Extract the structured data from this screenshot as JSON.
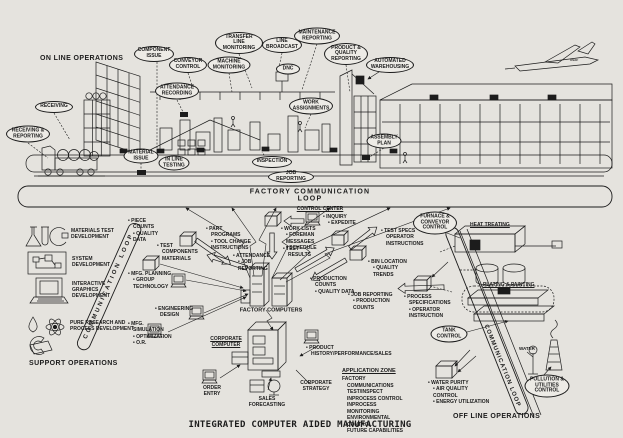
{
  "title": "INTEGRATED COMPUTER AIDED MANUFACTURING",
  "section_headings": {
    "on_line": "ON LINE OPERATIONS",
    "support": "SUPPORT OPERATIONS",
    "off_line": "OFF LINE OPERATIONS"
  },
  "loop_bands": {
    "factory": "FACTORY COMMUNICATION\nLOOP",
    "left_diagonal": "COMMUNICATION LOOP",
    "right_diagonal": "COMMUNICATION LOOP"
  },
  "callouts": {
    "component_issue": "COMPONENT\nISSUE",
    "conveyor_control": "CONVEYOR\nCONTROL",
    "machine_monitoring": "MACHINE\nMONITORING",
    "transfer_line_monitoring": "TRANSFER\nLINE\nMONITORING",
    "line_broadcast": "LINE\nBROADCAST",
    "dnc": "DNC",
    "maintenance_reporting": "MAINTENANCE\nREPORTING",
    "product_quality_reporting": "PRODUCT &\nQUALITY\nREPORTING",
    "automated_warehousing": "AUTOMATED\nWAREHOUSING",
    "attendance_recording": "ATTENDANCE\nRECORDING",
    "work_assignments": "WORK\nASSIGNMENTS",
    "receiving": "RECEIVING",
    "receiving_reporting": "RECEIVING &\nREPORTING",
    "material_issue": "MATERIAL\nISSUE",
    "in_line_testing": "IN LINE\nTESTING",
    "inspection": "INSPECTION",
    "job_reporting": "JOB REPORTING",
    "assembly_plan": "ASSEMBLY\nPLAN",
    "furnace_conveyor_control": "FURNACE &\nCONVEYOR\nCONTROL",
    "tank_control": "TANK\nCONTROL",
    "pollution_utilities_control": "POLLUTION &\nUTILITIES\nCONTROL"
  },
  "labels": {
    "control_center": "CONTROL CENTER",
    "factory_computers": "FACTORY COMPUTERS",
    "corporate_computer": "CORPORATE\nCOMPUTER",
    "heat_treating": "HEAT TREATING",
    "plating_painting": "PLATING & PAINTING",
    "application_zone": "APPLICATION ZONE",
    "water": "WATER",
    "order_entry": "ORDER\nENTRY",
    "sales_forecasting": "SALES\nFORECASTING",
    "corporate_strategy": "CORPORATE\nSTRATEGY",
    "airplane_marking": "USAF"
  },
  "bullet_lists": {
    "piece_counts": [
      "PIECE COUNTS",
      "QUALITY DATA"
    ],
    "test_components": [
      "TEST COMPONENTS MATERIALS"
    ],
    "mfg_planning": [
      "MFG. PLANNING",
      "GROUP TECHNOLOGY"
    ],
    "engineering_design": [
      "ENGINEERING DESIGN"
    ],
    "mfg_simulation": [
      "MFG. SIMULATION",
      "OPTIMIZATION",
      "O.R."
    ],
    "part_programs": [
      "PART PROGRAMS",
      "TOOL CHANGE INSTRUCTIONS"
    ],
    "attendance_job": [
      "ATTENDANCE",
      "JOB REPORTING"
    ],
    "work_lists": [
      "WORK LISTS",
      "FOREMAN MESSAGES",
      "SCHEDULE"
    ],
    "test_results": [
      "TEST RESULTS"
    ],
    "inquiry_expedite": [
      "INQUIRY",
      "EXPEDITE"
    ],
    "test_specs": [
      "TEST SPECS OPERATOR INSTRUCTIONS"
    ],
    "bin_location": [
      "BIN LOCATION",
      "QUALITY TRENDS"
    ],
    "production_counts": [
      "PRODUCTION COUNTS",
      "QUALITY DATA"
    ],
    "job_production": [
      "JOB REPORTING",
      "PRODUCTION COUNTS"
    ],
    "process_specs": [
      "PROCESS SPECIFICATIONS",
      "OPERATOR INSTRUCTION"
    ],
    "product_history": [
      "PRODUCT HISTORY/PERFORMANCE/SALES"
    ],
    "water_purity": [
      "WATER PURITY",
      "AIR QUALITY CONTROL",
      "ENERGY UTILIZATION"
    ]
  },
  "support_items": [
    {
      "label": "MATERIALS TEST\nDEVELOPMENT"
    },
    {
      "label": "SYSTEM\nDEVELOPMENT"
    },
    {
      "label": "INTERACTIVE\nGRAPHICS\nDEVELOPMENT"
    },
    {
      "label": "PURE RESEARCH AND\nPROCESS DEVELOPMENT"
    }
  ],
  "application_zone_items": [
    "FACTORY COMMUNICATIONS",
    "TEST/INSPECT",
    "INPROCESS CONTROL",
    "INPROCESS MONITORING",
    "ENVIRONMENTAL CONTROL",
    "FUTURE CAPABILITIES"
  ],
  "colors": {
    "paper": "#e5e3de",
    "ink": "#1c1c1c"
  }
}
